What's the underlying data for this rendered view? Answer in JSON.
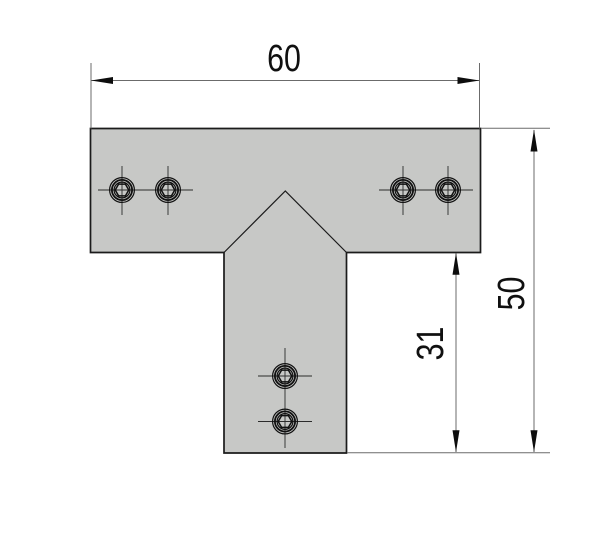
{
  "drawing": {
    "type": "technical-drawing",
    "part": "t-shaped-connector-plate",
    "dimensions": {
      "overall_width": "60",
      "overall_height": "50",
      "stem_height": "31"
    },
    "fasteners": {
      "icon": "hex-socket-screw-icon",
      "count": 6,
      "groups": [
        "top-left-pair",
        "top-right-pair",
        "stem-vertical-pair"
      ]
    },
    "colors": {
      "background": "#ffffff",
      "plate_fill": "#c7c8c6",
      "outline": "#1b1b1b",
      "dimension_line": "#6b6b6b",
      "arrow_fill": "#0d0d0d",
      "text": "#101010",
      "centerline": "#2b2b2b"
    }
  }
}
